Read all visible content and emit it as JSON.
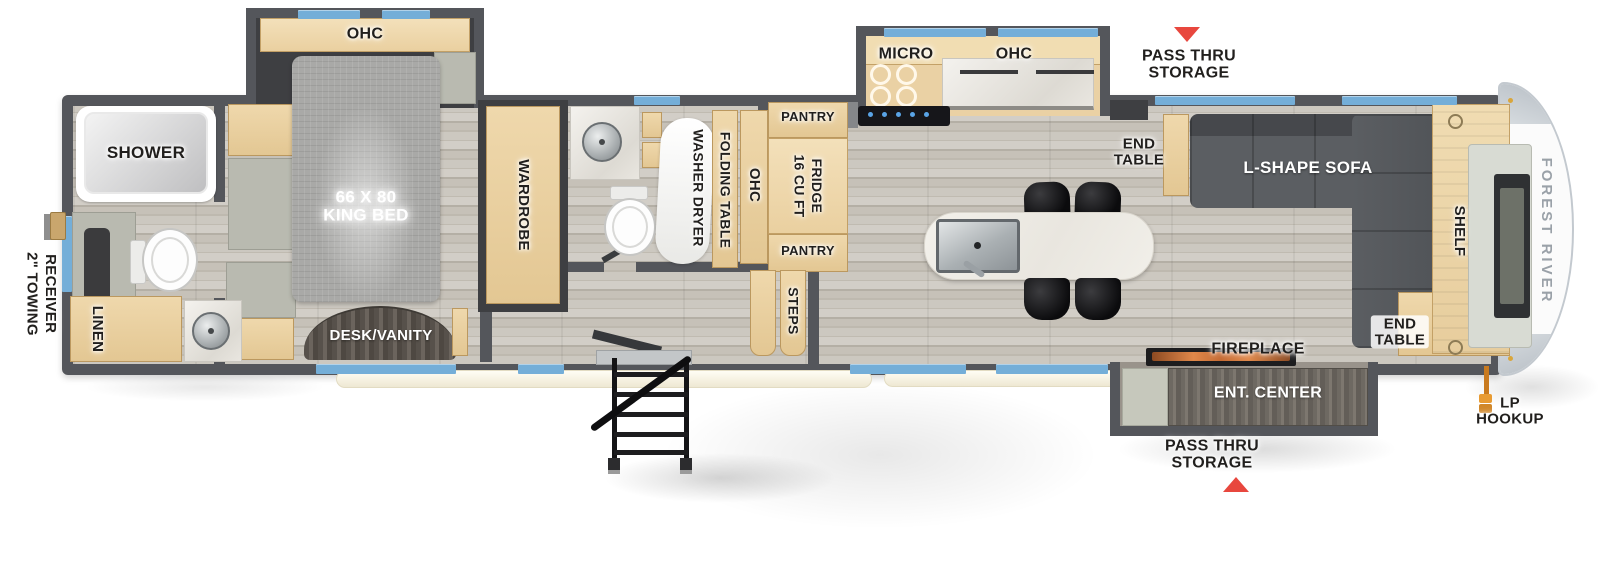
{
  "colors": {
    "wall": "#54565b",
    "window_blue": "#74aed8",
    "cabinet_tan": "#e8cfa1",
    "slide_interior": "#3e3f42",
    "floor_gray": "#c6c1b8",
    "sofa_gray": "#5b5e62",
    "bed_gray": "#a9a9a7",
    "marble_white": "#f0eee8",
    "accent_red": "#e8473e",
    "hose_orange": "#d78a26",
    "brand_gray": "#9aa1a8"
  },
  "labels": {
    "bedroom": {
      "ohc": "OHC",
      "bed_size_line1": "66 X 80",
      "bed_size_line2": "KING BED",
      "desk_vanity": "DESK/VANITY",
      "wardrobe": "WARDROBE"
    },
    "rear_bath": {
      "shower": "SHOWER",
      "linen": "LINEN"
    },
    "mid_bath": {
      "washer_dryer": "WASHER DRYER",
      "folding_table": "FOLDING TABLE",
      "ohc": "OHC"
    },
    "kitchen": {
      "pantry_top": "PANTRY",
      "fridge_line1": "16 CU FT",
      "fridge_line2": "FRIDGE",
      "pantry_bottom": "PANTRY",
      "steps": "STEPS",
      "micro": "MICRO",
      "ohc": "OHC"
    },
    "living": {
      "end_table_top_line1": "END",
      "end_table_top_line2": "TABLE",
      "sofa": "L-SHAPE SOFA",
      "shelf": "SHELF",
      "end_table_bottom_line1": "END",
      "end_table_bottom_line2": "TABLE",
      "fireplace": "FIREPLACE",
      "ent_center": "ENT. CENTER"
    },
    "exterior": {
      "towing_line1": "2\" TOWING",
      "towing_line2": "RECEIVER",
      "pass_thru_top_line1": "PASS THRU",
      "pass_thru_top_line2": "STORAGE",
      "pass_thru_bottom_line1": "PASS THRU",
      "pass_thru_bottom_line2": "STORAGE",
      "lp_line1": "LP",
      "lp_line2": "HOOKUP",
      "brand": "FOREST RIVER"
    }
  }
}
